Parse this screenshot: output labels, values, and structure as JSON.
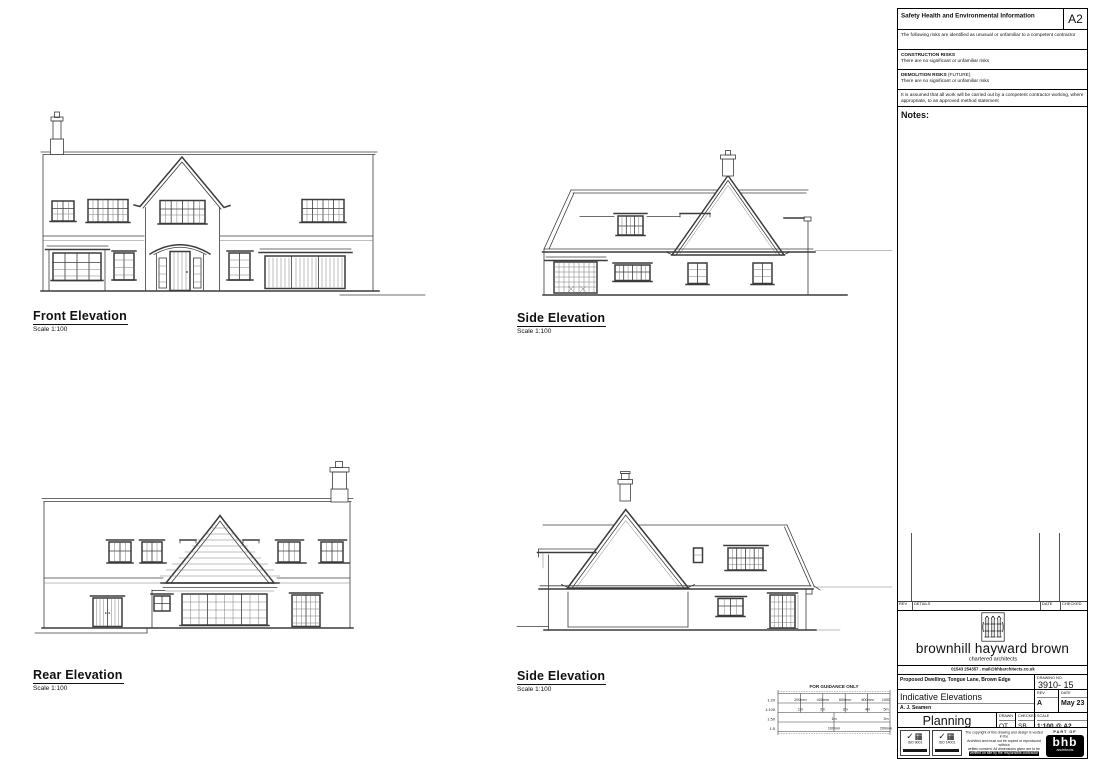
{
  "sheet": {
    "elevations": [
      {
        "label": "Front Elevation",
        "scale": "Scale 1:100"
      },
      {
        "label": "Side Elevation",
        "scale": "Scale 1:100"
      },
      {
        "label": "Rear Elevation",
        "scale": "Scale 1:100"
      },
      {
        "label": "Side Elevation",
        "scale": "Scale 1:100"
      }
    ],
    "scale_bar": {
      "title": "FOR GUIDANCE ONLY",
      "rows": [
        {
          "scale": "1:20",
          "labels": [
            "200mm",
            "400mm",
            "600mm",
            "800mm",
            "1000"
          ]
        },
        {
          "scale": "1:100",
          "labels": [
            "1m",
            "2m",
            "3m",
            "4m",
            "5m"
          ]
        },
        {
          "scale": "1:50",
          "labels": [
            "1m",
            "2m"
          ]
        },
        {
          "scale": "1:5",
          "labels": [
            "100mm",
            "200mm"
          ]
        }
      ]
    }
  },
  "panel": {
    "header": {
      "title": "Safety Health and Environmental Information",
      "sheet_size": "A2"
    },
    "risk_intro": "The following risks are identified as unusual or unfamiliar to a competent contractor",
    "construction": {
      "heading": "CONSTRUCTION RISKS",
      "body": "There are no significant or unfamiliar risks"
    },
    "demolition": {
      "heading": "DEMOLITION RISKS",
      "suffix": "(FUTURE)",
      "body": "There are no significant or unfamiliar risks"
    },
    "assumption": "It is assumed that all work will be carried out by a competent contractor working, where appropriate, to an approved method statement",
    "notes_label": "Notes:",
    "revision_table": {
      "headers": [
        "REV",
        "DETAILS",
        "DATE",
        "CHECKED"
      ]
    },
    "firm": {
      "name": "brownhill hayward brown",
      "tagline": "chartered architects",
      "contact": "01543 254357  .  mail@bhbarchitects.co.uk"
    },
    "title_block": {
      "project": "Proposed Dwelling, Tongue Lane, Brown Edge",
      "drawing_no_label": "DRAWING NO.",
      "drawing_no": "3910- 15",
      "drawing_title": "Indicative Elevations",
      "client": "A. J. Seamen",
      "rev_label": "REV",
      "rev": "A",
      "date_label": "DATE",
      "date": "May 23",
      "status": "Planning",
      "drawn_label": "DRAWN",
      "drawn": "OT",
      "checked_label": "CHECKED",
      "checked": "SB",
      "scale_label": "SCALE",
      "scale": "1:100 @ A2"
    },
    "footer": {
      "iso1": "ISO 9001",
      "iso2": "ISO 14001",
      "copyright_lines": [
        "The copyright of this drawing and design is vested in the",
        "Architect and must not be copied or reproduced without",
        "written consent. All dimensions given are to be",
        "verified on site by the responsible contractor"
      ],
      "part_of": "PART OF",
      "logo": "bhb",
      "logo_sub": "architects"
    }
  }
}
